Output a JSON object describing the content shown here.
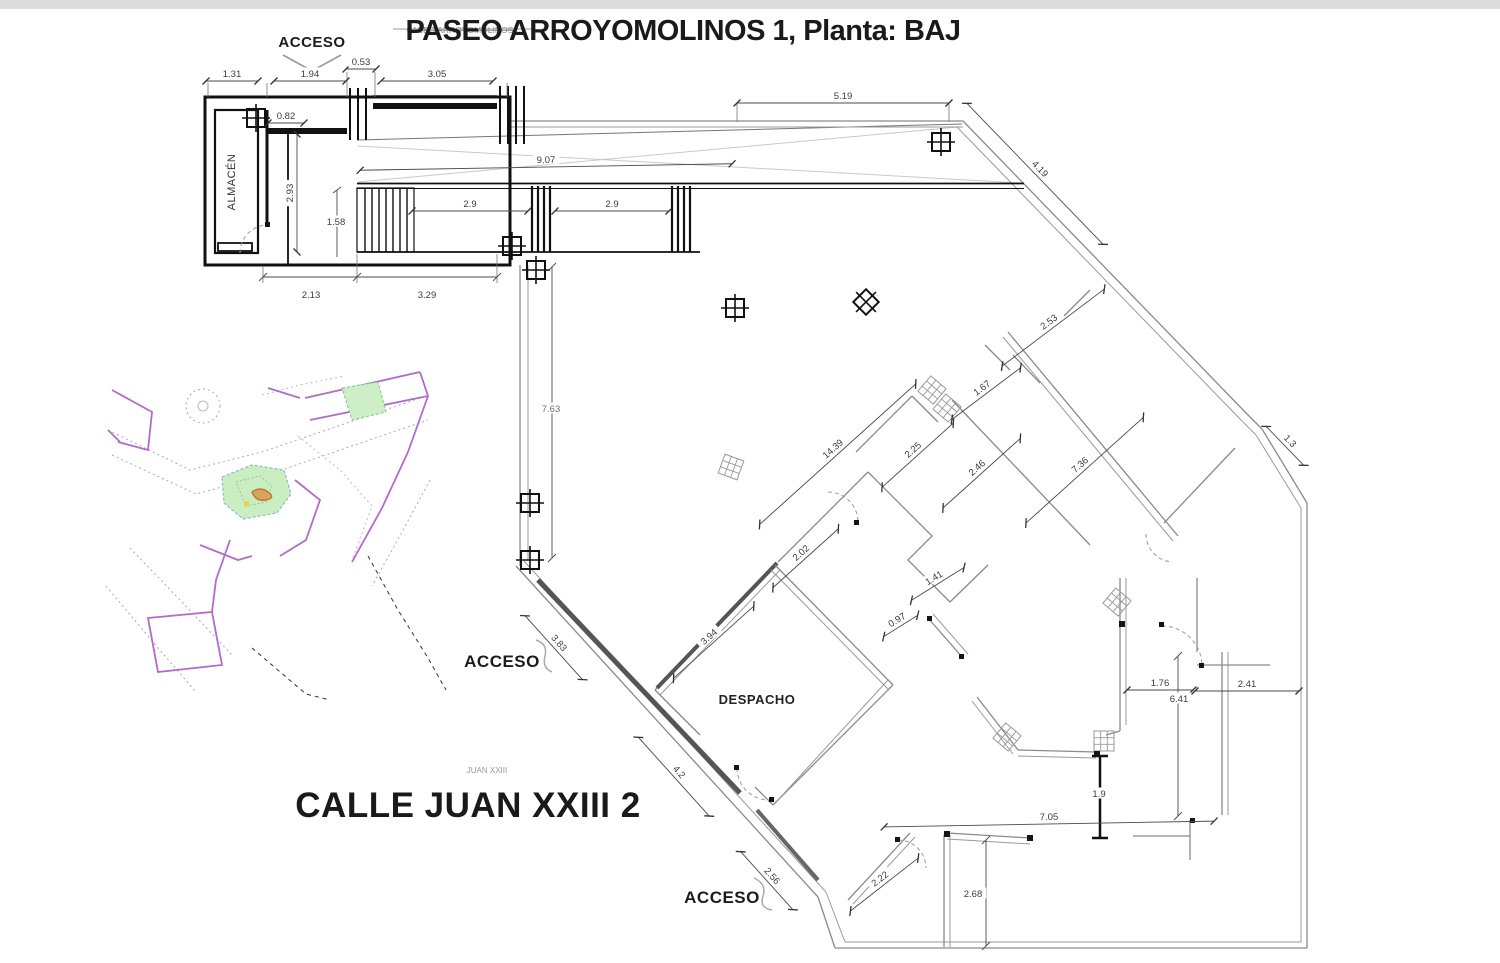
{
  "title": {
    "main": "PASEO ARROYOMOLINOS 1, Planta: BAJ",
    "overlay_small": "PASEO ARROYOMOLINOS"
  },
  "street_label": {
    "main": "CALLE JUAN XXIII 2",
    "small": "JUAN XXIII"
  },
  "plan": {
    "labels": [
      {
        "t": "ACCESO",
        "x": 312,
        "y": 47,
        "size": 15,
        "weight": "bold",
        "c": "#1c1c1c"
      },
      {
        "t": "ACCESO",
        "x": 502,
        "y": 667,
        "size": 17,
        "weight": "bold",
        "c": "#1c1c1c"
      },
      {
        "t": "ACCESO",
        "x": 722,
        "y": 903,
        "size": 17,
        "weight": "bold",
        "c": "#1c1c1c"
      },
      {
        "t": "ALMACÉN",
        "x": 235,
        "y": 182,
        "size": 11,
        "weight": "normal",
        "r": -90,
        "c": "#333333"
      },
      {
        "t": "DESPACHO",
        "x": 757,
        "y": 704,
        "size": 13,
        "weight": "bold",
        "c": "#222222"
      }
    ],
    "dimensions": [
      {
        "v": "1.31",
        "x": 232,
        "y": 74,
        "r": 0,
        "len": 52
      },
      {
        "v": "1.94",
        "x": 310,
        "y": 74,
        "r": 0,
        "len": 72
      },
      {
        "v": "0.53",
        "x": 361,
        "y": 62,
        "r": 0,
        "len": 30
      },
      {
        "v": "3.05",
        "x": 437,
        "y": 74,
        "r": 0,
        "len": 112
      },
      {
        "v": "0.82",
        "x": 286,
        "y": 116,
        "r": 0,
        "len": 36
      },
      {
        "v": "2.93",
        "x": 290,
        "y": 193,
        "r": -90,
        "len": 118
      },
      {
        "v": "1.58",
        "x": 336,
        "y": 222,
        "r": 0,
        "len": 0
      },
      {
        "v": "9.07",
        "x": 546,
        "y": 160,
        "r": -1,
        "len": 372
      },
      {
        "v": "2.9",
        "x": 470,
        "y": 204,
        "r": 0,
        "len": 116
      },
      {
        "v": "2.9",
        "x": 612,
        "y": 204,
        "r": 0,
        "len": 114
      },
      {
        "v": "2.13",
        "x": 311,
        "y": 295,
        "r": 0,
        "len": 0
      },
      {
        "v": "3.29",
        "x": 427,
        "y": 295,
        "r": 0,
        "len": 0
      },
      {
        "v": "5.19",
        "x": 843,
        "y": 96,
        "r": 0,
        "len": 212
      },
      {
        "v": "4.19",
        "x": 1040,
        "y": 169,
        "r": 46,
        "len": 196
      },
      {
        "v": "2.53",
        "x": 1049,
        "y": 322,
        "r": -37,
        "len": 128
      },
      {
        "v": "1.67",
        "x": 982,
        "y": 388,
        "r": -37,
        "len": 86
      },
      {
        "v": "2.25",
        "x": 913,
        "y": 450,
        "r": -42,
        "len": 96
      },
      {
        "v": "14.39",
        "x": 833,
        "y": 449,
        "r": -42,
        "len": 210
      },
      {
        "v": "2.46",
        "x": 977,
        "y": 468,
        "r": -42,
        "len": 104
      },
      {
        "v": "7.36",
        "x": 1080,
        "y": 465,
        "r": -42,
        "len": 158
      },
      {
        "v": "1.3",
        "x": 1290,
        "y": 441,
        "r": 46,
        "len": 54
      },
      {
        "v": "7.63",
        "x": 551,
        "y": 409,
        "r": 0,
        "len": 0,
        "c": "#707070"
      },
      {
        "v": "2.02",
        "x": 801,
        "y": 553,
        "r": -42,
        "len": 88
      },
      {
        "v": "1.41",
        "x": 934,
        "y": 578,
        "r": -32,
        "len": 62
      },
      {
        "v": "0.97",
        "x": 897,
        "y": 620,
        "r": -32,
        "len": 40
      },
      {
        "v": "3.94",
        "x": 709,
        "y": 637,
        "r": -42,
        "len": 108
      },
      {
        "v": "3.83",
        "x": 559,
        "y": 643,
        "r": 48,
        "len": 86
      },
      {
        "v": "4.2",
        "x": 679,
        "y": 772,
        "r": 48,
        "len": 106
      },
      {
        "v": "2.56",
        "x": 772,
        "y": 876,
        "r": 48,
        "len": 78
      },
      {
        "v": "2.22",
        "x": 880,
        "y": 879,
        "r": -38,
        "len": 86
      },
      {
        "v": "2.68",
        "x": 973,
        "y": 894,
        "r": 0,
        "len": 0
      },
      {
        "v": "7.05",
        "x": 1049,
        "y": 817,
        "r": -1,
        "len": 330
      },
      {
        "v": "1.9",
        "x": 1099,
        "y": 794,
        "r": 0,
        "len": 0
      },
      {
        "v": "1.76",
        "x": 1160,
        "y": 683,
        "r": 0,
        "len": 66
      },
      {
        "v": "6.41",
        "x": 1179,
        "y": 699,
        "r": 0,
        "len": 0
      },
      {
        "v": "2.41",
        "x": 1247,
        "y": 684,
        "r": 0,
        "len": 104
      }
    ],
    "colors": {
      "wall": "#111111",
      "thin_wall": "#8a8a8a",
      "dim_text": "#3c3c3c",
      "map_purple": "#b36bc9",
      "map_green_fill": "#cdeec6",
      "map_green_stroke": "#7fc87f",
      "map_orange": "#c07a30",
      "map_yellow": "#e8d44a"
    }
  }
}
